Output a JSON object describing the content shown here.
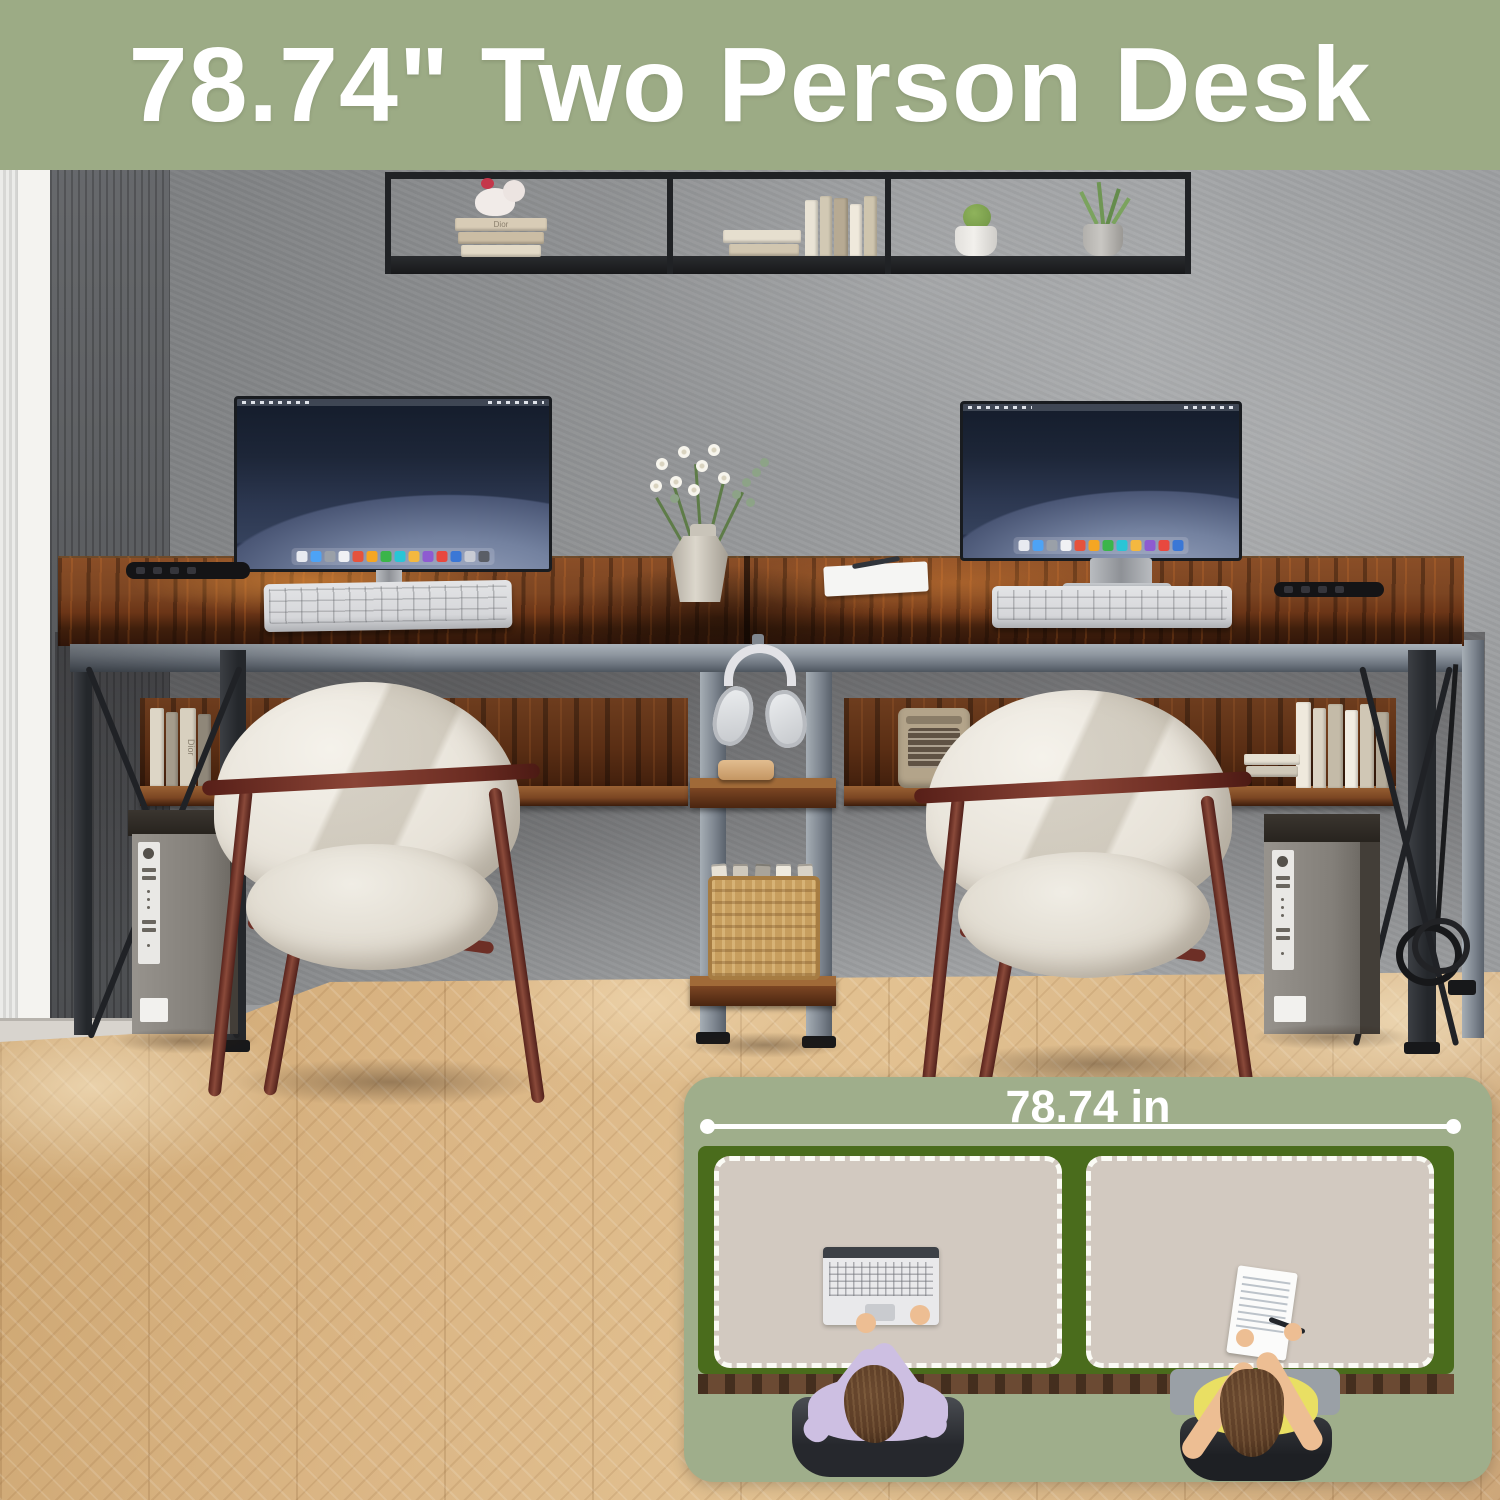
{
  "banner": {
    "title": "78.74\" Two Person Desk"
  },
  "inset": {
    "dimension_label": "78.74 in"
  },
  "decor": {
    "book_spine_label": "Dior"
  },
  "palette": {
    "banner_bg": "#9CAB85",
    "banner_text": "#FFFFFF",
    "inset_bg": "#9FAE8B",
    "diagram_green": "#4A6C1C",
    "mat_beige": "#D2C9C0",
    "mat_border": "#FBFBF5",
    "desk_edge_brown": "#6B4A33",
    "person1_shirt": "#CDBFE2",
    "person2_top": "#E9DF63",
    "skin_tone": "#EDBE93",
    "hair_brown": "#5C3D26",
    "chair_black": "#26282D",
    "chair_cream": "#EAE6DC",
    "chair_wood": "#73332A",
    "wall_mid": "#909294",
    "wall_dark": "#5B5D60",
    "window_frame": "#F4F3F0",
    "floor_wood": "#D9B687",
    "desk_wood": "#7A4524",
    "metal_gray": "#8A929B",
    "metal_dark": "#2E3135",
    "shelf_black": "#202225",
    "keyboard_light": "#D6D7DA",
    "screen_navy": "#1D2638",
    "headphone_white": "#E2E2E6",
    "basket_tan": "#C79E5E",
    "radio_tan": "#B3A48A",
    "pc_gray": "#8F8B85"
  }
}
